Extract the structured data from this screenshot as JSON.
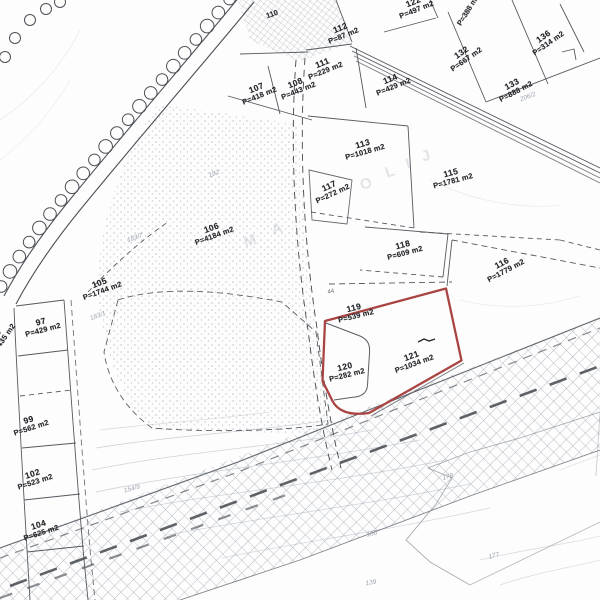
{
  "map": {
    "kind": "cadastral parcel plan (scanned)",
    "colors": {
      "highlight_outline": "#a94442",
      "parcel_line": "#55595f",
      "faint_ref": "#8b94a0"
    },
    "highlighted_parcels": [
      "120",
      "121"
    ]
  },
  "parcels": [
    {
      "id": "107",
      "area": "P=418 m2",
      "x": 258,
      "y": 92,
      "rot": -22
    },
    {
      "id": "108",
      "area": "P=443 m2",
      "x": 297,
      "y": 87,
      "rot": -22
    },
    {
      "id": "111",
      "area": "P=229 m2",
      "x": 324,
      "y": 67,
      "rot": -22
    },
    {
      "id": "112",
      "area": "P=87 m2",
      "x": 342,
      "y": 32,
      "rot": -22
    },
    {
      "id": "122",
      "area": "P=497 m2",
      "x": 415,
      "y": 6,
      "rot": -22
    },
    {
      "id": "114",
      "area": "P=429 m2",
      "x": 392,
      "y": 83,
      "rot": -22
    },
    {
      "id": "113",
      "area": "P=1018 m2",
      "x": 364,
      "y": 148,
      "rot": -16
    },
    {
      "id": "117",
      "area": "P=272 m2",
      "x": 331,
      "y": 190,
      "rot": -25
    },
    {
      "id": "115",
      "area": "P=1781 m2",
      "x": 452,
      "y": 177,
      "rot": -15
    },
    {
      "id": "132",
      "area": "P=667 m2",
      "x": 464,
      "y": 56,
      "rot": -35
    },
    {
      "id": "133",
      "area": "P=888 m2",
      "x": 514,
      "y": 88,
      "rot": -28
    },
    {
      "id": "136",
      "area": "P=314 m2",
      "x": 546,
      "y": 40,
      "rot": -35
    },
    {
      "id": "106",
      "area": "P=4184 m2",
      "x": 213,
      "y": 232,
      "rot": -20
    },
    {
      "id": "105",
      "area": "P=1744 m2",
      "x": 101,
      "y": 287,
      "rot": -20
    },
    {
      "id": "97",
      "area": "P=429 m2",
      "x": 42,
      "y": 326,
      "rot": -15
    },
    {
      "id": "96",
      "area": "P=435 m2",
      "x": 0,
      "y": 337,
      "rot": -55
    },
    {
      "id": "99",
      "area": "P=562 m2",
      "x": 30,
      "y": 424,
      "rot": -18
    },
    {
      "id": "102",
      "area": "P=523 m2",
      "x": 34,
      "y": 478,
      "rot": -18
    },
    {
      "id": "104",
      "area": "P=625 m2",
      "x": 40,
      "y": 529,
      "rot": -18
    },
    {
      "id": "118",
      "area": "P=609 m2",
      "x": 404,
      "y": 249,
      "rot": -15
    },
    {
      "id": "116",
      "area": "P=1779 m2",
      "x": 504,
      "y": 267,
      "rot": -28
    },
    {
      "id": "119",
      "area": "P=539 m2",
      "x": 355,
      "y": 312,
      "rot": -14
    },
    {
      "id": "120",
      "area": "P=282 m2",
      "x": 346,
      "y": 371,
      "rot": -14
    },
    {
      "id": "121",
      "area": "P=1034 m2",
      "x": 413,
      "y": 360,
      "rot": -20
    }
  ],
  "edge_fragments": [
    {
      "text": "110",
      "x": 272,
      "y": 14,
      "rot": -20
    },
    {
      "text": "P=388 m2",
      "x": 468,
      "y": 10,
      "rot": -58
    }
  ],
  "faint_refs": [
    {
      "text": "182",
      "x": 214,
      "y": 174,
      "rot": -20
    },
    {
      "text": "183/7",
      "x": 135,
      "y": 238,
      "rot": -20
    },
    {
      "text": "183/1",
      "x": 98,
      "y": 316,
      "rot": -20
    },
    {
      "text": "206/2",
      "x": 528,
      "y": 97,
      "rot": -20
    },
    {
      "text": "154/9",
      "x": 132,
      "y": 489,
      "rot": -15
    },
    {
      "text": "178",
      "x": 448,
      "y": 477,
      "rot": -15
    },
    {
      "text": "180",
      "x": 372,
      "y": 534,
      "rot": -12
    },
    {
      "text": "177",
      "x": 494,
      "y": 556,
      "rot": -15
    },
    {
      "text": "139",
      "x": 371,
      "y": 583,
      "rot": -10
    }
  ],
  "watermark_letters": [
    {
      "ch": "M",
      "x": 250,
      "y": 241
    },
    {
      "ch": "A",
      "x": 277,
      "y": 229
    },
    {
      "ch": "O",
      "x": 366,
      "y": 184
    },
    {
      "ch": "L",
      "x": 390,
      "y": 172
    },
    {
      "ch": "I",
      "x": 408,
      "y": 164
    },
    {
      "ch": "J",
      "x": 426,
      "y": 156
    }
  ],
  "tick_marks": [
    {
      "text": "44",
      "x": 331,
      "y": 292,
      "rot": -10
    }
  ]
}
